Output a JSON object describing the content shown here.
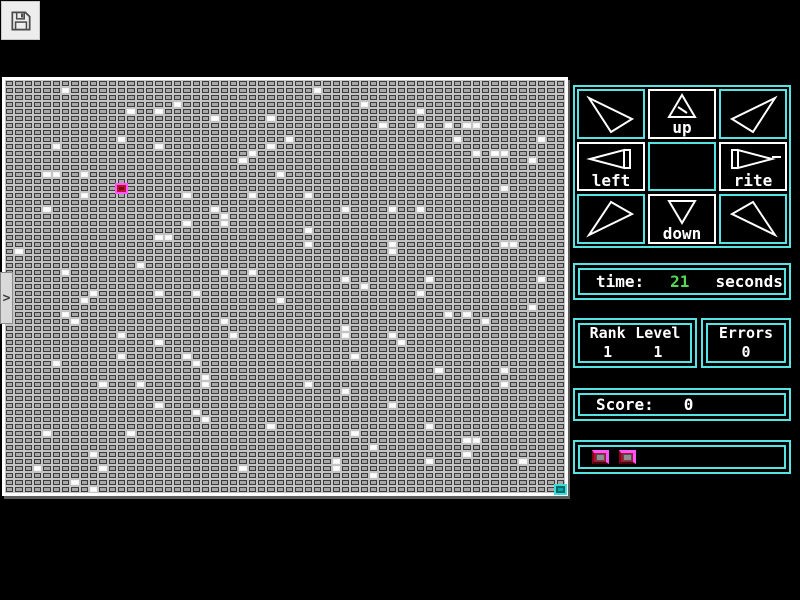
{
  "theme": {
    "bg": "#000000",
    "cyan": "#55e3e3",
    "green": "#55d955",
    "pink": "#ff55ff",
    "button_red": "#b01030",
    "board_bg": "#c4c4c4",
    "cell_fill": "#a8a8a8",
    "cell_border": "#3c3c3c",
    "cursor_red": "#7a0818",
    "goal_teal": "#00aaaa"
  },
  "toolbar": {
    "save_icon": "floppy-disk"
  },
  "side_tab": {
    "chevron": ">"
  },
  "dpad": {
    "up": {
      "label": "up"
    },
    "down": {
      "label": "down"
    },
    "left": {
      "label": "left"
    },
    "rite": {
      "label": "rite"
    },
    "diagonals": [
      "up-left",
      "up-right",
      "down-left",
      "down-right"
    ]
  },
  "stats": {
    "time": {
      "label": "time:",
      "value": "21",
      "unit": "seconds"
    },
    "rank": {
      "label": "Rank",
      "value": "1"
    },
    "level": {
      "label": "Level",
      "value": "1"
    },
    "errors": {
      "label": "Errors",
      "value": "0"
    },
    "score": {
      "label": "Score:",
      "value": "0"
    }
  },
  "buttons_panel": {
    "buttons": [
      "red-button-1",
      "red-button-2"
    ]
  },
  "board": {
    "cols": 60,
    "rows": 59,
    "cursor": {
      "col": 12,
      "row": 15
    },
    "goal": {
      "col": 59,
      "row": 58
    },
    "dots": [
      [
        6,
        1
      ],
      [
        13,
        4
      ],
      [
        16,
        4
      ],
      [
        18,
        3
      ],
      [
        22,
        5
      ],
      [
        28,
        5
      ],
      [
        12,
        8
      ],
      [
        5,
        9
      ],
      [
        16,
        9
      ],
      [
        28,
        9
      ],
      [
        26,
        10
      ],
      [
        25,
        11
      ],
      [
        5,
        13
      ],
      [
        4,
        13
      ],
      [
        8,
        13
      ],
      [
        29,
        13
      ],
      [
        19,
        16
      ],
      [
        26,
        16
      ],
      [
        8,
        16
      ],
      [
        4,
        18
      ],
      [
        22,
        18
      ],
      [
        23,
        19
      ],
      [
        23,
        20
      ],
      [
        19,
        20
      ],
      [
        16,
        22
      ],
      [
        17,
        22
      ],
      [
        1,
        24
      ],
      [
        14,
        26
      ],
      [
        6,
        27
      ],
      [
        23,
        27
      ],
      [
        26,
        27
      ],
      [
        33,
        1
      ],
      [
        38,
        3
      ],
      [
        44,
        4
      ],
      [
        44,
        6
      ],
      [
        47,
        6
      ],
      [
        49,
        6
      ],
      [
        50,
        6
      ],
      [
        40,
        6
      ],
      [
        30,
        8
      ],
      [
        48,
        8
      ],
      [
        57,
        8
      ],
      [
        52,
        10
      ],
      [
        50,
        10
      ],
      [
        53,
        10
      ],
      [
        56,
        11
      ],
      [
        53,
        15
      ],
      [
        32,
        16
      ],
      [
        36,
        18
      ],
      [
        44,
        18
      ],
      [
        41,
        18
      ],
      [
        32,
        21
      ],
      [
        54,
        23
      ],
      [
        32,
        23
      ],
      [
        41,
        23
      ],
      [
        41,
        24
      ],
      [
        53,
        23
      ],
      [
        36,
        28
      ],
      [
        45,
        28
      ],
      [
        38,
        29
      ],
      [
        57,
        28
      ],
      [
        16,
        30
      ],
      [
        9,
        30
      ],
      [
        20,
        30
      ],
      [
        8,
        31
      ],
      [
        29,
        31
      ],
      [
        6,
        33
      ],
      [
        7,
        34
      ],
      [
        23,
        34
      ],
      [
        12,
        36
      ],
      [
        16,
        37
      ],
      [
        24,
        36
      ],
      [
        12,
        39
      ],
      [
        19,
        39
      ],
      [
        20,
        40
      ],
      [
        5,
        40
      ],
      [
        21,
        42
      ],
      [
        10,
        43
      ],
      [
        14,
        43
      ],
      [
        21,
        43
      ],
      [
        16,
        46
      ],
      [
        20,
        47
      ],
      [
        21,
        48
      ],
      [
        28,
        49
      ],
      [
        4,
        50
      ],
      [
        13,
        50
      ],
      [
        9,
        53
      ],
      [
        3,
        55
      ],
      [
        10,
        55
      ],
      [
        25,
        55
      ],
      [
        7,
        57
      ],
      [
        9,
        58
      ],
      [
        44,
        30
      ],
      [
        56,
        32
      ],
      [
        47,
        33
      ],
      [
        49,
        33
      ],
      [
        51,
        34
      ],
      [
        36,
        35
      ],
      [
        36,
        36
      ],
      [
        41,
        36
      ],
      [
        42,
        37
      ],
      [
        37,
        39
      ],
      [
        46,
        41
      ],
      [
        53,
        41
      ],
      [
        53,
        43
      ],
      [
        32,
        43
      ],
      [
        36,
        44
      ],
      [
        41,
        46
      ],
      [
        45,
        49
      ],
      [
        37,
        50
      ],
      [
        39,
        52
      ],
      [
        49,
        51
      ],
      [
        50,
        51
      ],
      [
        49,
        53
      ],
      [
        35,
        54
      ],
      [
        45,
        54
      ],
      [
        55,
        54
      ],
      [
        35,
        55
      ],
      [
        39,
        56
      ]
    ]
  }
}
